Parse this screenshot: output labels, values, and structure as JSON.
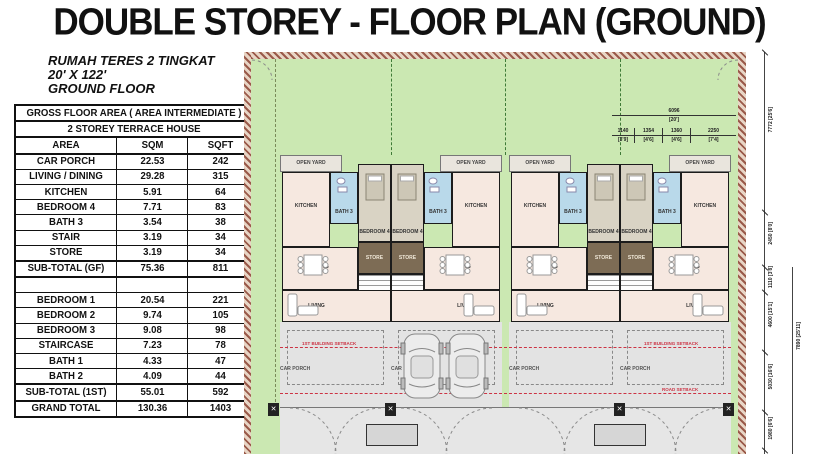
{
  "title": "DOUBLE STOREY - FLOOR PLAN (GROUND)",
  "subtitle": {
    "line1": "RUMAH TERES 2 TINGKAT",
    "line2": "20' X 122'",
    "line3": "GROUND FLOOR"
  },
  "area_table": {
    "title": "GROSS FLOOR AREA ( AREA INTERMEDIATE )",
    "subtitle": "2 STOREY TERRACE HOUSE",
    "columns": {
      "area": "AREA",
      "sqm": "SQM",
      "sqft": "SQFT"
    },
    "ground_rows": [
      {
        "area": "CAR PORCH",
        "sqm": "22.53",
        "sqft": "242"
      },
      {
        "area": "LIVING / DINING",
        "sqm": "29.28",
        "sqft": "315"
      },
      {
        "area": "KITCHEN",
        "sqm": "5.91",
        "sqft": "64"
      },
      {
        "area": "BEDROOM 4",
        "sqm": "7.71",
        "sqft": "83"
      },
      {
        "area": "BATH 3",
        "sqm": "3.54",
        "sqft": "38"
      },
      {
        "area": "STAIR",
        "sqm": "3.19",
        "sqft": "34"
      },
      {
        "area": "STORE",
        "sqm": "3.19",
        "sqft": "34"
      }
    ],
    "subtotal_gf": {
      "area": "SUB-TOTAL (GF)",
      "sqm": "75.36",
      "sqft": "811"
    },
    "first_rows": [
      {
        "area": "BEDROOM 1",
        "sqm": "20.54",
        "sqft": "221"
      },
      {
        "area": "BEDROOM 2",
        "sqm": "9.74",
        "sqft": "105"
      },
      {
        "area": "BEDROOM 3",
        "sqm": "9.08",
        "sqft": "98"
      },
      {
        "area": "STAIRCASE",
        "sqm": "7.23",
        "sqft": "78"
      },
      {
        "area": "BATH 1",
        "sqm": "4.33",
        "sqft": "47"
      },
      {
        "area": "BATH 2",
        "sqm": "4.09",
        "sqft": "44"
      }
    ],
    "subtotal_1st": {
      "area": "SUB-TOTAL (1ST)",
      "sqm": "55.01",
      "sqft": "592"
    },
    "grand_total": {
      "area": "GRAND TOTAL",
      "sqm": "130.36",
      "sqft": "1403"
    }
  },
  "plan": {
    "labels": {
      "open_yard": "OPEN YARD",
      "kitchen": "KITCHEN",
      "bath3": "BATH 3",
      "bedroom4": "BEDROOM 4",
      "dining": "DINING",
      "living": "LIVING",
      "store": "STORE",
      "stair": "STAIR",
      "car_porch": "CAR PORCH",
      "setback1": "1ST BUILDING SETBACK",
      "setback2": "ROAD SETBACK"
    },
    "dimensions": {
      "top_total_mm": "6096",
      "top_total_ft": "[20']",
      "top_segments": [
        {
          "mm": "1140",
          "ft": "[3'9]"
        },
        {
          "mm": "1354",
          "ft": "[4'6]"
        },
        {
          "mm": "1360",
          "ft": "[4'6]"
        },
        {
          "mm": "2250",
          "ft": "[7'4]"
        }
      ],
      "right_segments": [
        {
          "mm": "7772",
          "ft": "[25'6]"
        },
        {
          "mm": "2450",
          "ft": "[8'0]"
        },
        {
          "mm": "1110",
          "ft": "[3'8]"
        },
        {
          "mm": "4600",
          "ft": "[15'1]"
        },
        {
          "mm": "5030",
          "ft": "[16'6]"
        },
        {
          "mm": "1980",
          "ft": "[6'6]"
        }
      ],
      "right_overall": {
        "mm": "7890",
        "ft": "[25'11]"
      }
    },
    "colors": {
      "yard_green": "#cbe8b2",
      "room_pink": "#f6e8e0",
      "bath_blue": "#b9d9ea",
      "bedroom_tan": "#d9d3c4",
      "store_brown": "#7d6c55",
      "porch_grey": "#e3e3e3",
      "boundary_hatch": "#9a5a4a",
      "setback_red": "#cc3344"
    }
  }
}
